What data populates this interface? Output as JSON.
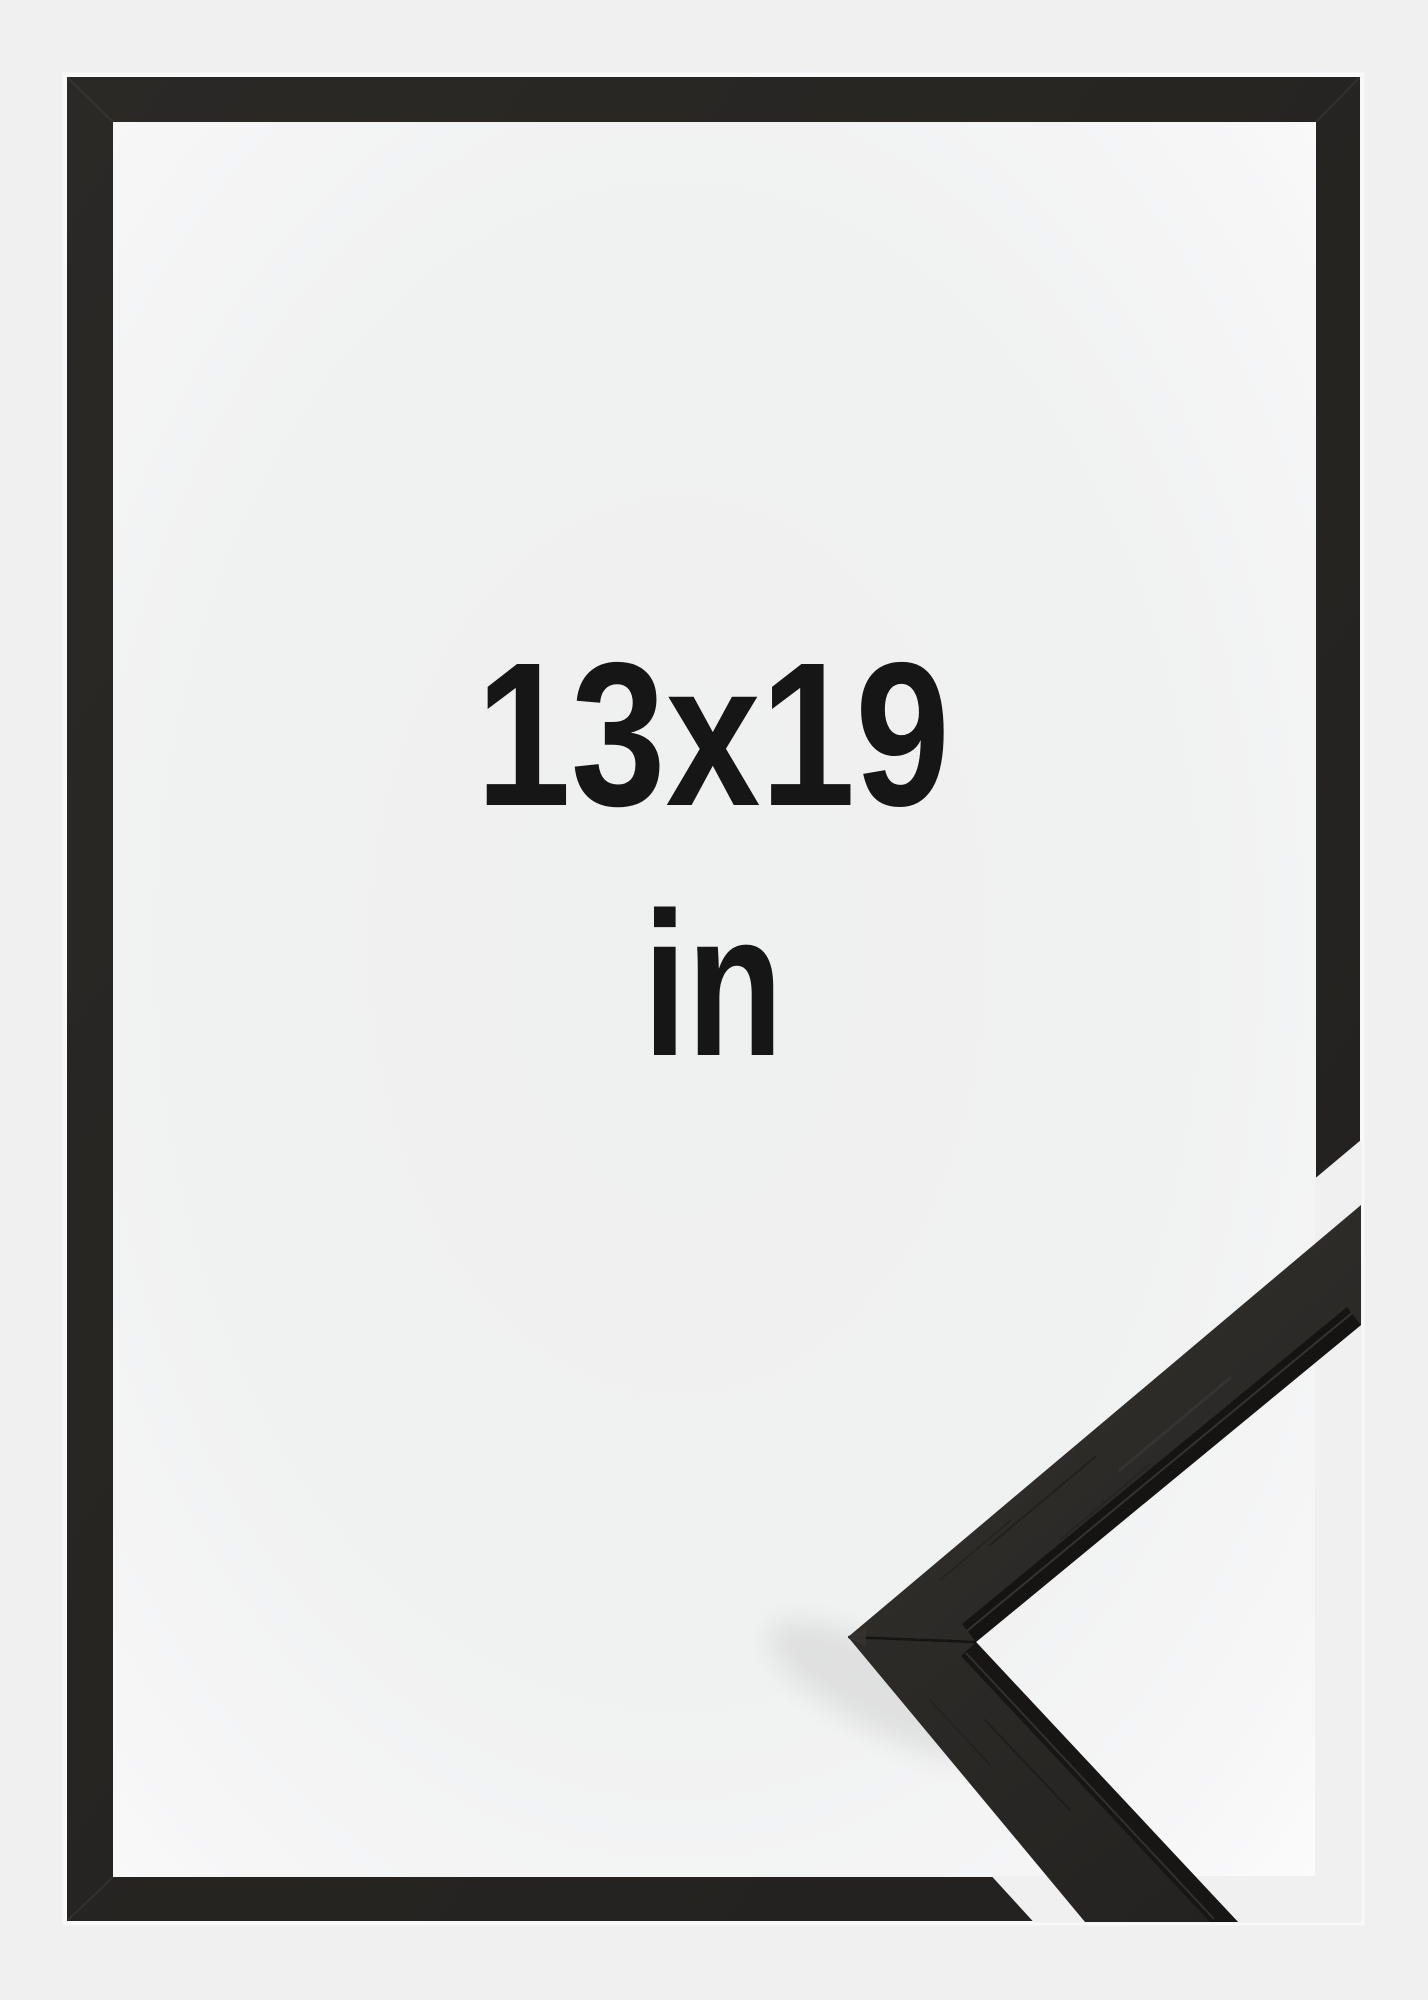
{
  "size_label": {
    "dimensions": "13x19",
    "unit": "in"
  },
  "colors": {
    "background": "#f0f0f1",
    "inner_window": "#f5f5f6",
    "frame": "#262421",
    "frame_profile_face": "#2e2c29",
    "frame_profile_lip": "#151413",
    "text": "#161616"
  }
}
